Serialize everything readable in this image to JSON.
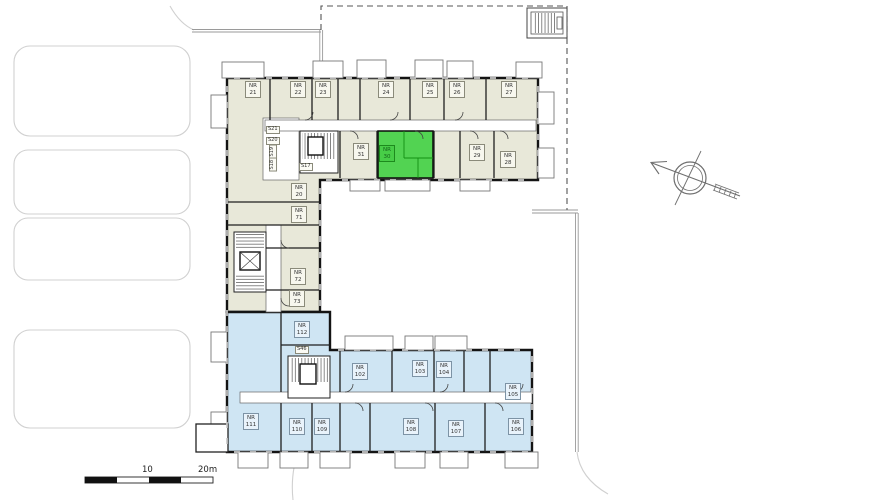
{
  "plan_meta": {
    "type": "apartment-building-floor-plan",
    "highlighted_unit": "NR 30"
  },
  "colors": {
    "north_wing_fill": "#e8e8d9",
    "south_wing_fill": "#cfe5f3",
    "highlight_fill": "#52d352",
    "wall": "#141414",
    "site_line": "#d0d0d0",
    "boundary_dash": "#555555"
  },
  "rooms": [
    {
      "label": "NR 21"
    },
    {
      "label": "NR 22"
    },
    {
      "label": "NR 23"
    },
    {
      "label": "NR 24"
    },
    {
      "label": "NR 25"
    },
    {
      "label": "NR 26"
    },
    {
      "label": "NR 27"
    },
    {
      "label": "NR 28"
    },
    {
      "label": "NR 29"
    },
    {
      "label": "NR 30"
    },
    {
      "label": "NR 31"
    },
    {
      "label": "NR 20"
    },
    {
      "label": "NR 71"
    },
    {
      "label": "NR 72"
    },
    {
      "label": "NR 73"
    },
    {
      "label": "NR 102"
    },
    {
      "label": "NR 103"
    },
    {
      "label": "NR 104"
    },
    {
      "label": "NR 105"
    },
    {
      "label": "NR 106"
    },
    {
      "label": "NR 107"
    },
    {
      "label": "NR 108"
    },
    {
      "label": "NR 109"
    },
    {
      "label": "NR 110"
    },
    {
      "label": "NR 111"
    },
    {
      "label": "NR 112"
    }
  ],
  "stairs": [
    {
      "label": "S21"
    },
    {
      "label": "S20"
    },
    {
      "label": "S19"
    },
    {
      "label": "S18"
    },
    {
      "label": "S17"
    },
    {
      "label": "S46"
    }
  ],
  "scale_bar": {
    "mid": "10",
    "end": "20m"
  },
  "icons": {
    "north_arrow": "north-arrow-compass"
  }
}
